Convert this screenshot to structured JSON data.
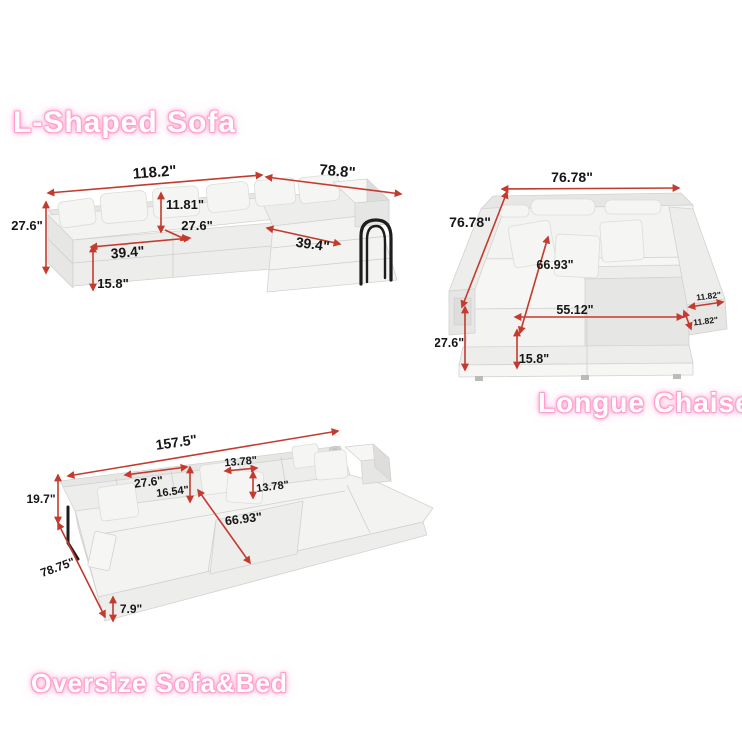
{
  "page": {
    "background": "#ffffff"
  },
  "colors": {
    "dimension_red": "#c43a2e",
    "dimension_text": "#161616",
    "title_pink_glow": "#ff8fc5",
    "title_fill": "#fffdfe",
    "sofa_fabric_light": "#f3f3f1",
    "sofa_fabric_shade": "#e6e6e4",
    "handle_black": "#1d1d1d"
  },
  "sections": {
    "l_shaped": {
      "title": "L-Shaped Sofa",
      "dims": {
        "total_width": "118.2\"",
        "chaise_length": "78.8\"",
        "pillow_height": "11.81\"",
        "overall_height": "27.6\"",
        "seat_depth": "27.6\"",
        "seat_width": "39.4\"",
        "chaise_seat_width": "39.4\"",
        "base_height": "15.8\""
      }
    },
    "longue_chaise": {
      "title": "Longue Chaise",
      "dims": {
        "total_width": "76.78\"",
        "total_depth": "76.78\"",
        "inner_depth": "66.93\"",
        "inner_width": "55.12\"",
        "arm_width_top": "11.82\"",
        "arm_width_side": "11.82\"",
        "overall_height": "27.6\"",
        "base_height": "15.8\""
      }
    },
    "oversize": {
      "title": "Oversize Sofa&Bed",
      "dims": {
        "total_length": "157.5\"",
        "back_cushion_width": "27.6\"",
        "pillow_width": "13.78\"",
        "back_height": "16.54\"",
        "pillow_height": "13.78\"",
        "bed_depth": "66.93\"",
        "overall_height": "19.7\"",
        "total_depth": "78.75\"",
        "mattress_height": "7.9\""
      }
    }
  }
}
